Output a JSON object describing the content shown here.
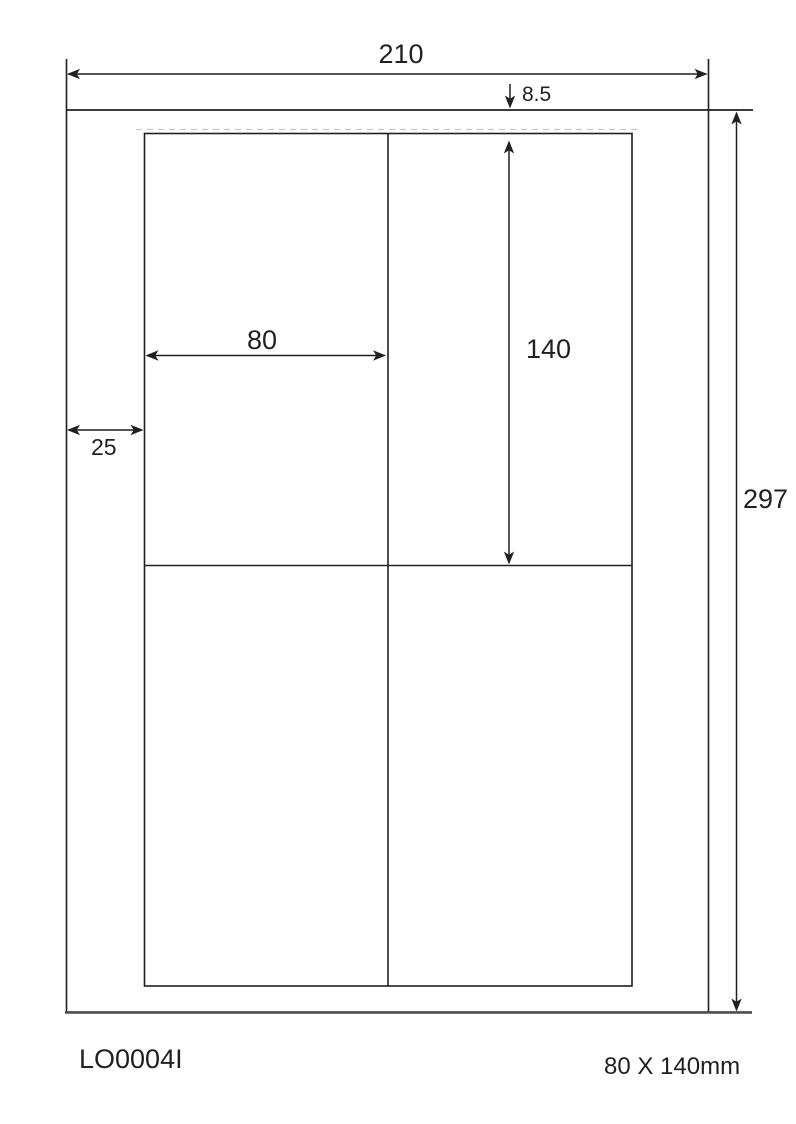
{
  "diagram": {
    "dimensions": {
      "page_width": "210",
      "top_margin": "8.5",
      "label_width": "80",
      "label_height": "140",
      "left_margin": "25",
      "page_height": "297"
    },
    "footer": {
      "product_code": "LO0004I",
      "label_format": "80 X 140mm"
    },
    "colors": {
      "line": "#231f20",
      "sheet_baseline": "#4d4d4d",
      "perforation": "#c6c6c6",
      "background": "#ffffff"
    }
  }
}
